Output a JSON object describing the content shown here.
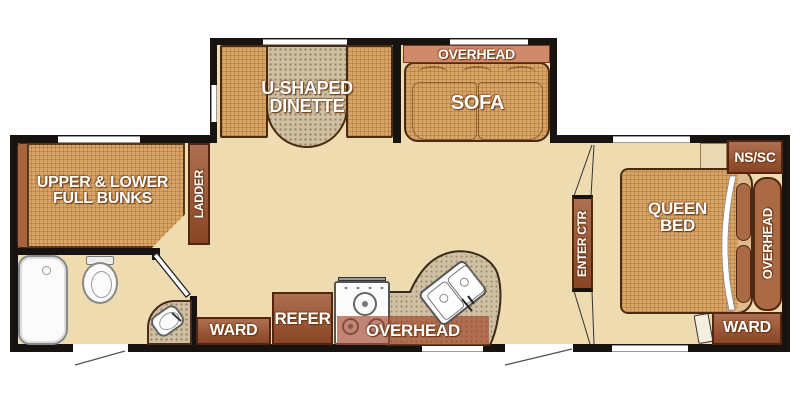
{
  "title": "travel trailer floor plan",
  "colors": {
    "wall": "#171310",
    "floor": "#eedbb0",
    "furniture-tan": "#d9a567",
    "cabinet": "#9c4f2b",
    "cabinet-border": "#53250e",
    "cabinet-light": "#aa6a45",
    "overhead-salmon": "#cf8a6a",
    "speckle": "#cfc0a3",
    "white-fixture": "#fbfbfb"
  },
  "labels": {
    "bunks": "UPPER & LOWER FULL BUNKS",
    "ladder": "LADDER",
    "dinette": "U-SHAPED DINETTE",
    "sofa": "SOFA",
    "sofa_overhead": "OVERHEAD",
    "ns_sc": "NS/SC",
    "queen_bed": "QUEEN BED",
    "bedroom_overhead": "OVERHEAD",
    "bedroom_ward": "WARD",
    "enter_ctr": "ENTER CTR",
    "kitchen_ward": "WARD",
    "refer": "REFER",
    "kitchen_overhead": "OVERHEAD"
  }
}
